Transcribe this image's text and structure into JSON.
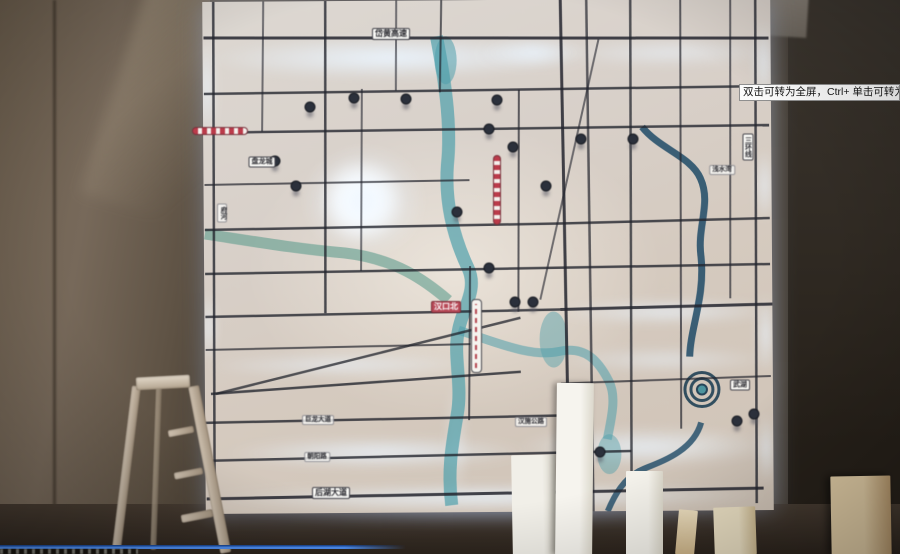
{
  "player": {
    "tooltip_text": "双击可转为全屏，Ctrl+ 单击可转为",
    "progress_percent": 45,
    "colors": {
      "progress_blue": "#4f8ff2",
      "tooltip_bg": "#fbfbfb"
    }
  },
  "map_wall": {
    "colors": {
      "glow_blue": "#cfe6ff",
      "river_teal": "#4f9fab",
      "river_dark": "#1e4a66",
      "metro_red": "#b84a58",
      "panel_base": "#d8d0c9"
    },
    "road_labels": [
      {
        "text": "岱黄高速",
        "kind": "pill",
        "x": 391,
        "y": 34,
        "vertical": false
      },
      {
        "text": "三环线",
        "kind": "pill-sm",
        "x": 748,
        "y": 147,
        "vertical": true
      },
      {
        "text": "浅水湾",
        "kind": "tiny",
        "x": 722,
        "y": 170,
        "vertical": false
      },
      {
        "text": "府河",
        "kind": "tiny",
        "x": 222,
        "y": 213,
        "vertical": true
      },
      {
        "text": "盘龙城",
        "kind": "pill-sm",
        "x": 262,
        "y": 162,
        "vertical": false
      },
      {
        "text": "汉口北",
        "kind": "red",
        "x": 446,
        "y": 307,
        "vertical": false
      },
      {
        "text": "武湖",
        "kind": "pill-sm",
        "x": 740,
        "y": 385,
        "vertical": false
      },
      {
        "text": "巨龙大道",
        "kind": "tiny",
        "x": 318,
        "y": 420,
        "vertical": false
      },
      {
        "text": "朝阳路",
        "kind": "tiny",
        "x": 317,
        "y": 457,
        "vertical": false
      },
      {
        "text": "后湖大道",
        "kind": "pill",
        "x": 331,
        "y": 493,
        "vertical": false
      },
      {
        "text": "汉施公路",
        "kind": "tiny",
        "x": 531,
        "y": 422,
        "vertical": false
      }
    ],
    "logo_markers": [
      [
        310,
        107
      ],
      [
        354,
        98
      ],
      [
        406,
        99
      ],
      [
        497,
        100
      ],
      [
        489,
        129
      ],
      [
        513,
        147
      ],
      [
        546,
        186
      ],
      [
        581,
        139
      ],
      [
        633,
        139
      ],
      [
        275,
        161
      ],
      [
        296,
        186
      ],
      [
        457,
        212
      ],
      [
        489,
        268
      ],
      [
        515,
        302
      ],
      [
        533,
        302
      ],
      [
        600,
        452
      ],
      [
        737,
        421
      ],
      [
        754,
        414
      ]
    ]
  }
}
